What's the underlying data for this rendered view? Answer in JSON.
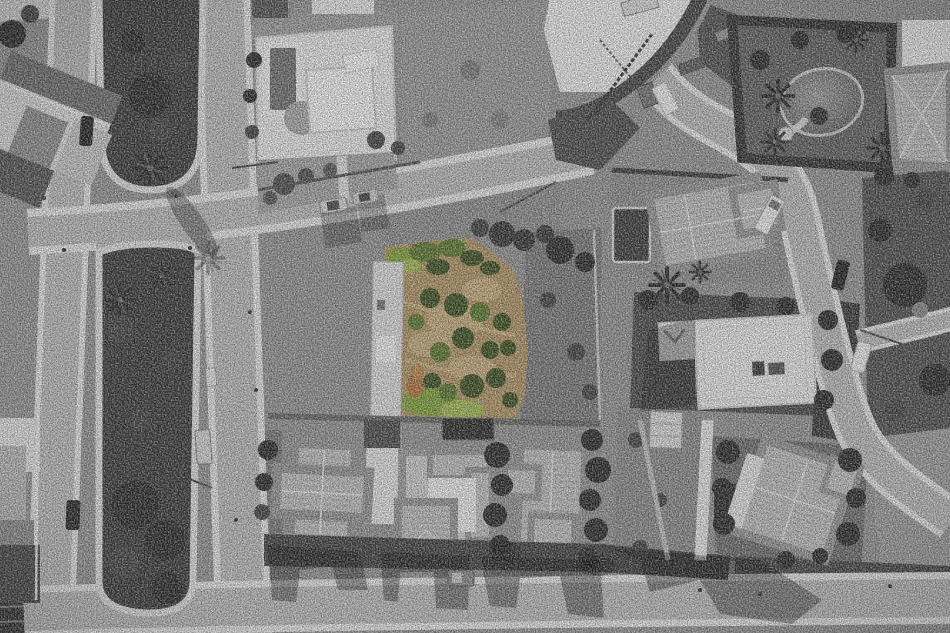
{
  "meta": {
    "image_type": "aerial-drone-photograph",
    "treatment": "black-and-white photograph with a single land plot kept in colour",
    "orientation": "top-down"
  },
  "palette": {
    "ground": "#969696",
    "road": "#bdbdbd",
    "road_light": "#cfcfcf",
    "cobble": "#e7e7e7",
    "median_veg": "#3e3e3e",
    "tree_dark": "#2e2e2e",
    "tree_gray": "#474747",
    "scrub": "#8f8f8f",
    "scrub_dark": "#787878",
    "veg_east": "#525252",
    "white_roof": "#ececec",
    "white_wall": "#f4f4f4",
    "court_gray": "#a6a6a6",
    "tile_roof": "#c2c2c2",
    "tile_roof_dark": "#979797",
    "tile_ridge": "#e6e6e6",
    "pool_gray": "#737373",
    "pool_dark": "#3d3d3d",
    "gravel": "#f0f0f0",
    "car_dark": "#262626",
    "car_silver": "#d6d6d6",
    "car_white": "#f2f2f2",
    "plot_dirt": "#b39766",
    "plot_dirt_light": "#c9ae7e",
    "plot_green_dark": "#3e5323",
    "plot_green": "#5d7a2f",
    "plot_green_bright": "#84a43c",
    "plot_grass": "#a4ba52",
    "plot_branches": "#b4763f"
  },
  "scene": {
    "highlighted_plot": {
      "name": "colour-highlighted-vacant-plot",
      "vegetation": [
        "green shrubs",
        "dry tan earth",
        "lime grass band",
        "orange cut-branch pile"
      ]
    },
    "roads": [
      "left boulevard with planted medians",
      "upper cross street",
      "curved main road from top",
      "right-side road",
      "bottom road",
      "right spur road"
    ],
    "buildings": [
      "top-left house",
      "modern flat-roof villa with pool",
      "construction site with tower crane",
      "villa with garden pond",
      "top-right tiled-roof house",
      "mid-right villa with pool",
      "white flat-roof building",
      "three bottom villas",
      "bottom-right villa",
      "left-edge house",
      "small shed"
    ],
    "vehicles": [
      "dark car on left road top",
      "dark car on left road bottom",
      "two silver cars on cross street",
      "white van at construction site",
      "truck at top edge",
      "dark car on right road",
      "white car on right road",
      "van on bottom road",
      "truck beside lower median"
    ]
  }
}
